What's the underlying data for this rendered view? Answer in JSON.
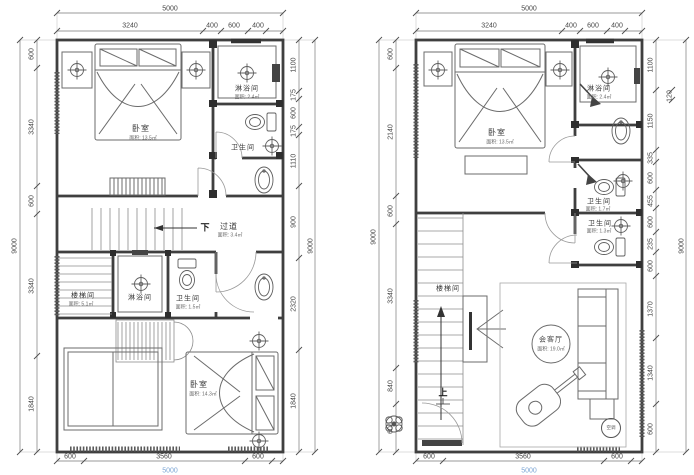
{
  "colors": {
    "wall": "#3f3f3f",
    "light_line": "#8c8c8c",
    "dim_text": "#474747",
    "highlight_dim": "#7aa4d4"
  },
  "plans": [
    {
      "name": "upper-floor-plan",
      "rooms": {
        "bedroom_top": {
          "label": "卧室",
          "area": "面积: 13.5㎡"
        },
        "shower_top": {
          "label": "淋浴间",
          "area": "面积: 2.4㎡"
        },
        "wc_top": {
          "label": "卫生间"
        },
        "corridor": {
          "label": "过道",
          "area": "面积: 3.4㎡",
          "direction": "下"
        },
        "stairwell": {
          "label": "楼梯间",
          "area": "面积: 5.1㎡"
        },
        "shower_mid": {
          "label": "淋浴间"
        },
        "wc_mid": {
          "label": "卫生间",
          "area": "面积: 1.5㎡"
        },
        "bedroom_bottom": {
          "label": "卧室",
          "area": "面积: 14.3㎡"
        }
      },
      "dims": {
        "top_total": "5000",
        "top": [
          "3240",
          "400",
          "600",
          "400"
        ],
        "bottom": [
          "600",
          "3560",
          "600"
        ],
        "bottom_total": "5000",
        "left_total": "9000",
        "left": [
          "600",
          "3340",
          "600",
          "3340",
          "1840"
        ],
        "right": [
          "1100",
          "175",
          "600",
          "175",
          "1110",
          "900",
          "2320",
          "1840"
        ],
        "right_total": "9000"
      }
    },
    {
      "name": "lower-floor-plan",
      "rooms": {
        "bedroom": {
          "label": "卧室",
          "area": "面积: 13.5㎡"
        },
        "shower": {
          "label": "淋浴间",
          "area": "面积: 2.4㎡"
        },
        "wc_upper": {
          "label": "卫生间",
          "area": "面积: 1.7㎡"
        },
        "wc_lower": {
          "label": "卫生间",
          "area": "面积: 1.3㎡"
        },
        "stairwell": {
          "label": "楼梯间",
          "direction": "上"
        },
        "living": {
          "label": "会客厅",
          "area": "面积: 19.0㎡"
        },
        "ac": {
          "label": "空调"
        }
      },
      "dims": {
        "top_total": "5000",
        "top": [
          "3240",
          "400",
          "600",
          "400"
        ],
        "bottom": [
          "600",
          "3560",
          "600"
        ],
        "bottom_total": "5000",
        "left_total": "9000",
        "left": [
          "600",
          "2140",
          "600",
          "3340",
          "840",
          "600"
        ],
        "right": [
          "1100",
          "1150",
          "335",
          "600",
          "455",
          "600",
          "235",
          "600",
          "1370",
          "1340",
          "600"
        ],
        "right_extra": "120",
        "right_total": "9000"
      }
    }
  ]
}
